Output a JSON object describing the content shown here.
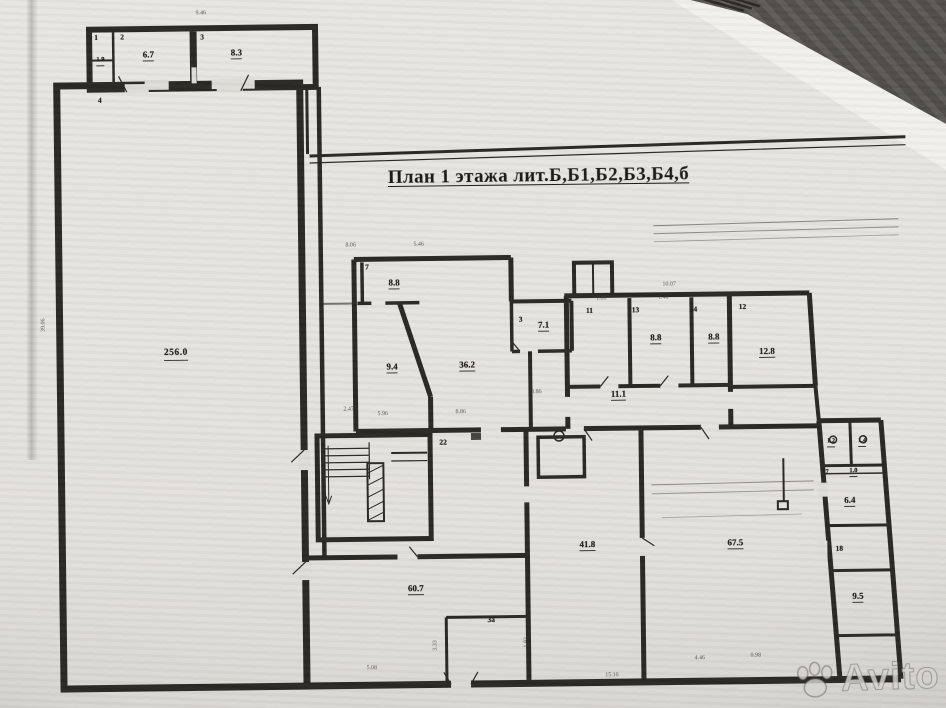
{
  "photo": {
    "backdrop_color": "#57544f",
    "paper_color": "#dedcd7",
    "ink_color": "#26241f"
  },
  "title": {
    "text": "План 1 этажа лит.Б,Б1,Б2,Б3,Б4,б"
  },
  "watermark": {
    "brand": "Avito",
    "icon": "paw-icon"
  },
  "rooms": [
    {
      "num": "1",
      "area": "1.9"
    },
    {
      "num": "2",
      "area": "6.7"
    },
    {
      "num": "3",
      "area": "8.3"
    },
    {
      "num": "4",
      "area": "256.0"
    },
    {
      "num": "7",
      "area": "8.8"
    },
    {
      "area": "9.4"
    },
    {
      "area": "36.2"
    },
    {
      "num": "3",
      "area": "7.1"
    },
    {
      "num": "11"
    },
    {
      "num": "13",
      "area": "8.8"
    },
    {
      "num": "14",
      "area": "8.8"
    },
    {
      "num": "12",
      "area": "12.8"
    },
    {
      "area": "11.1"
    },
    {
      "num": "22"
    },
    {
      "area": "41.8"
    },
    {
      "area": "67.5"
    },
    {
      "area": "60.7"
    },
    {
      "num": "3а"
    },
    {
      "area": "1.2"
    },
    {
      "area": "1.4"
    },
    {
      "num": "17",
      "area": "1.0"
    },
    {
      "area": "6.4"
    },
    {
      "num": "18"
    },
    {
      "area": "9.5"
    }
  ],
  "dims": [
    {
      "v": "9.46"
    },
    {
      "v": "8.06"
    },
    {
      "v": "5.46"
    },
    {
      "v": "10.07"
    },
    {
      "v": "1.86"
    },
    {
      "v": "1.40"
    },
    {
      "v": "2.47"
    },
    {
      "v": "5.96"
    },
    {
      "v": "8.86"
    },
    {
      "v": "3.86"
    },
    {
      "v": "39.06"
    },
    {
      "v": "3.33"
    },
    {
      "v": "1.93"
    },
    {
      "v": "5.08"
    },
    {
      "v": "15.16"
    },
    {
      "v": "4.46"
    },
    {
      "v": "0.98"
    }
  ]
}
